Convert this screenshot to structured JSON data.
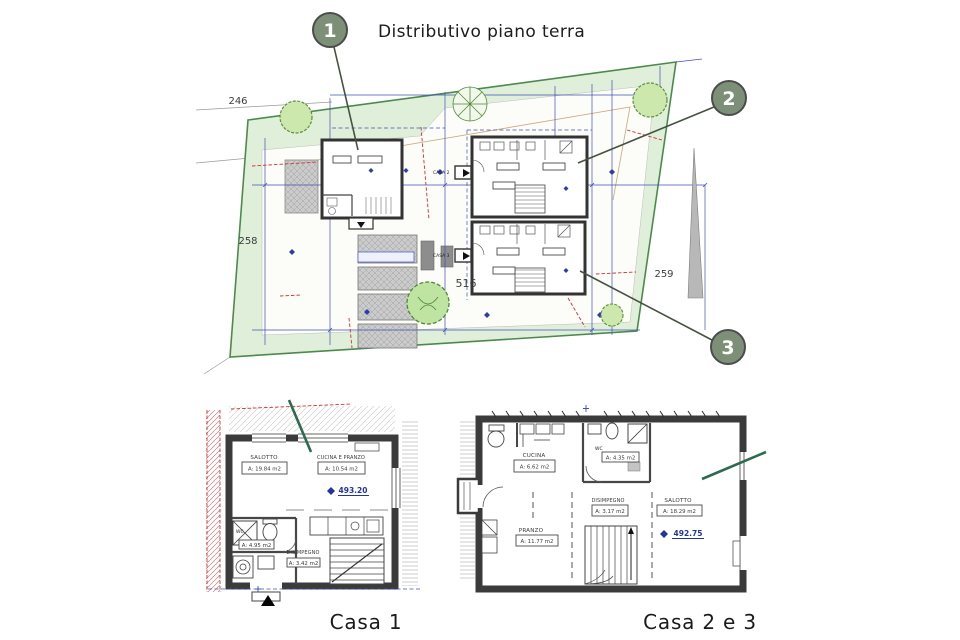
{
  "title": {
    "marker": "1",
    "text": "Distributivo piano terra"
  },
  "site_plan": {
    "markers": {
      "m1": "1",
      "m2": "2",
      "m3": "3"
    },
    "parcels": {
      "p246": "246",
      "p258": "258",
      "p259": "259",
      "p516": "516"
    },
    "house_labels": {
      "casa2": "CASA 2",
      "casa3": "CASA 3"
    }
  },
  "casa1": {
    "caption": "Casa 1",
    "elevation": "493.20",
    "rooms": {
      "salotto": {
        "name": "SALOTTO",
        "area": "A: 19.84 m2"
      },
      "cucina_pranzo": {
        "name": "CUCINA E PRANZO",
        "area": "A: 10.54 m2"
      },
      "wc": {
        "name": "WC",
        "area": "A: 4.95 m2"
      },
      "disimpegno": {
        "name": "DISIMPEGNO",
        "area": "A: 3.42 m2"
      }
    }
  },
  "casa23": {
    "caption": "Casa 2 e 3",
    "elevation": "492.75",
    "rooms": {
      "cucina": {
        "name": "CUCINA",
        "area": "A: 6.62 m2"
      },
      "wc": {
        "name": "WC",
        "area": "A: 4.35 m2"
      },
      "disimpegno": {
        "name": "DISIMPEGNO",
        "area": "A: 3.17 m2"
      },
      "salotto": {
        "name": "SALOTTO",
        "area": "A: 18.29 m2"
      },
      "pranzo": {
        "name": "PRANZO",
        "area": "A: 11.77 m2"
      }
    }
  },
  "colors": {
    "marker_fill": "#7d9077",
    "site_fill": "#e0efda",
    "site_border": "#4c8a4c",
    "dimension_blue": "#3f51b5",
    "elevation_blue": "#2333a0",
    "accent_red": "#cc3333",
    "section_green": "#2d6b50",
    "wall_dark": "#3b3b3b"
  }
}
